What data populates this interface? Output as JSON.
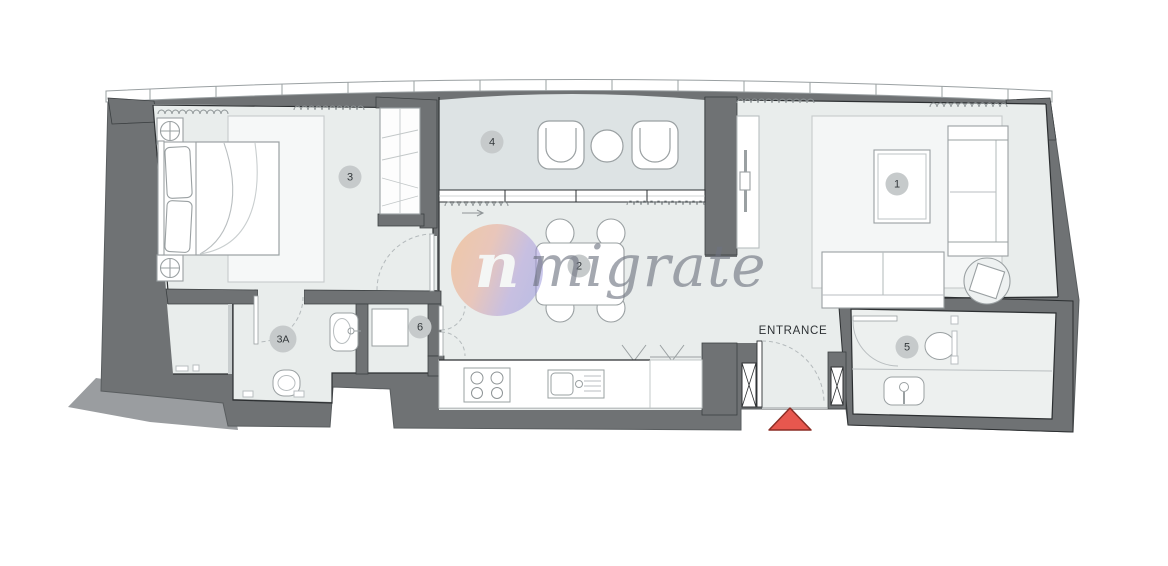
{
  "floorplan": {
    "watermark": {
      "text": "migrate",
      "logo_glyph": "n"
    },
    "entrance": {
      "label": "ENTRANCE",
      "marker": "red-triangle",
      "marker_color": "#e7574e"
    },
    "rooms": [
      {
        "name": "living-room",
        "badge": "1"
      },
      {
        "name": "dining-area",
        "badge": "2"
      },
      {
        "name": "bedroom",
        "badge": "3"
      },
      {
        "name": "ensuite-bathroom",
        "badge": "3A"
      },
      {
        "name": "balcony",
        "badge": "4"
      },
      {
        "name": "bathroom",
        "badge": "5"
      },
      {
        "name": "laundry",
        "badge": "6"
      }
    ],
    "colors": {
      "wall": "#6f7274",
      "outer_mass": "#9a9da0",
      "floor": "#e9edec",
      "balcony_floor": "#dde3e4",
      "badge_bg": "#c6cacb",
      "accent_red": "#e7574e",
      "watermark_gradient_start": "#f2a468",
      "watermark_gradient_end": "#8e8fd9"
    }
  }
}
